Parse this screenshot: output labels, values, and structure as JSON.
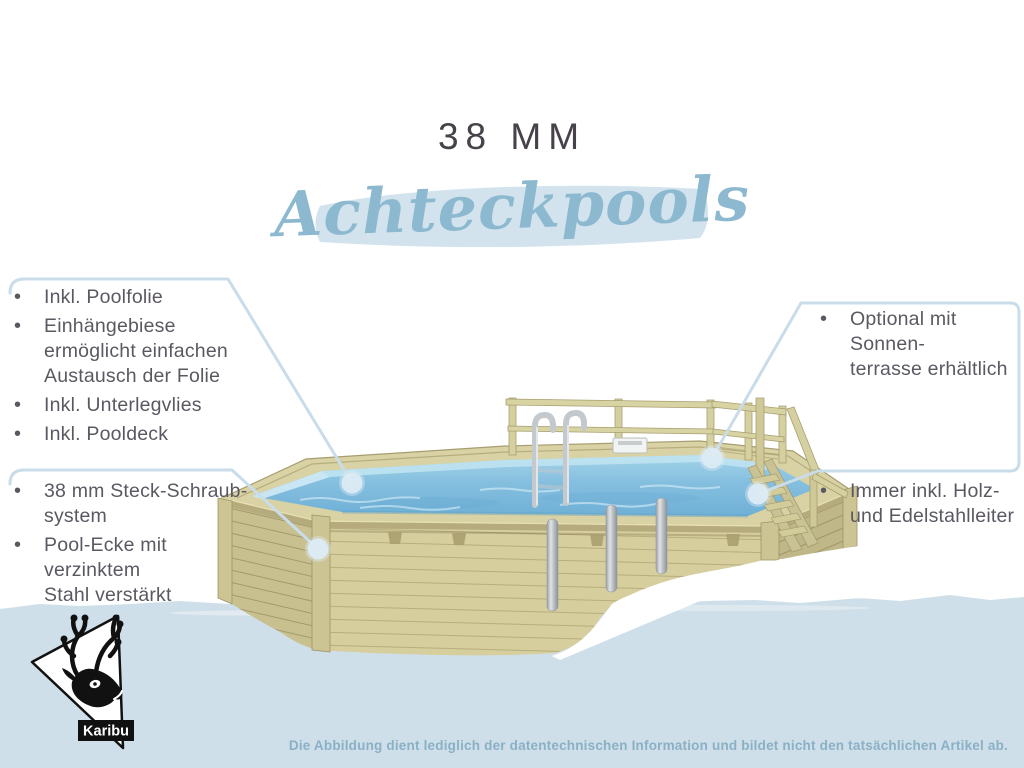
{
  "page": {
    "title": "38 MM",
    "subtitle": "Achteckpools",
    "brand": "Karibu",
    "footer_disclaimer": "Die Abbildung dient lediglich der datentechnischen Information und bildet nicht den tatsächlichen Artikel ab."
  },
  "glyphs": {
    "bullet": "•"
  },
  "features": {
    "left_top": [
      "Inkl. Poolfolie",
      "Einhängebiese\nermöglicht einfachen\nAustausch der Folie",
      "Inkl. Unterlegvlies",
      "Inkl. Pooldeck"
    ],
    "left_bottom": [
      "38 mm Steck-Schraub-\nsystem",
      "Pool-Ecke mit verzinktem\nStahl verstärkt"
    ],
    "right_top": [
      "Optional mit Sonnen-\nterrasse erhältlich"
    ],
    "right_bottom": [
      "Immer inkl. Holz-\nund Edelstahlleiter"
    ]
  },
  "icons": {
    "logo": "karibu-deer-logo"
  },
  "colors": {
    "accent_blue": "#8cb9cf",
    "highlight_band": "#d2e3ee",
    "callout_line": "#c9dcea",
    "callout_dot": "#dcebf4",
    "bottom_band": "#cfdfe9",
    "title_text": "#474149",
    "body_text": "#5c5862",
    "footer_text": "#8ab0c6",
    "logo_black": "#111111"
  }
}
